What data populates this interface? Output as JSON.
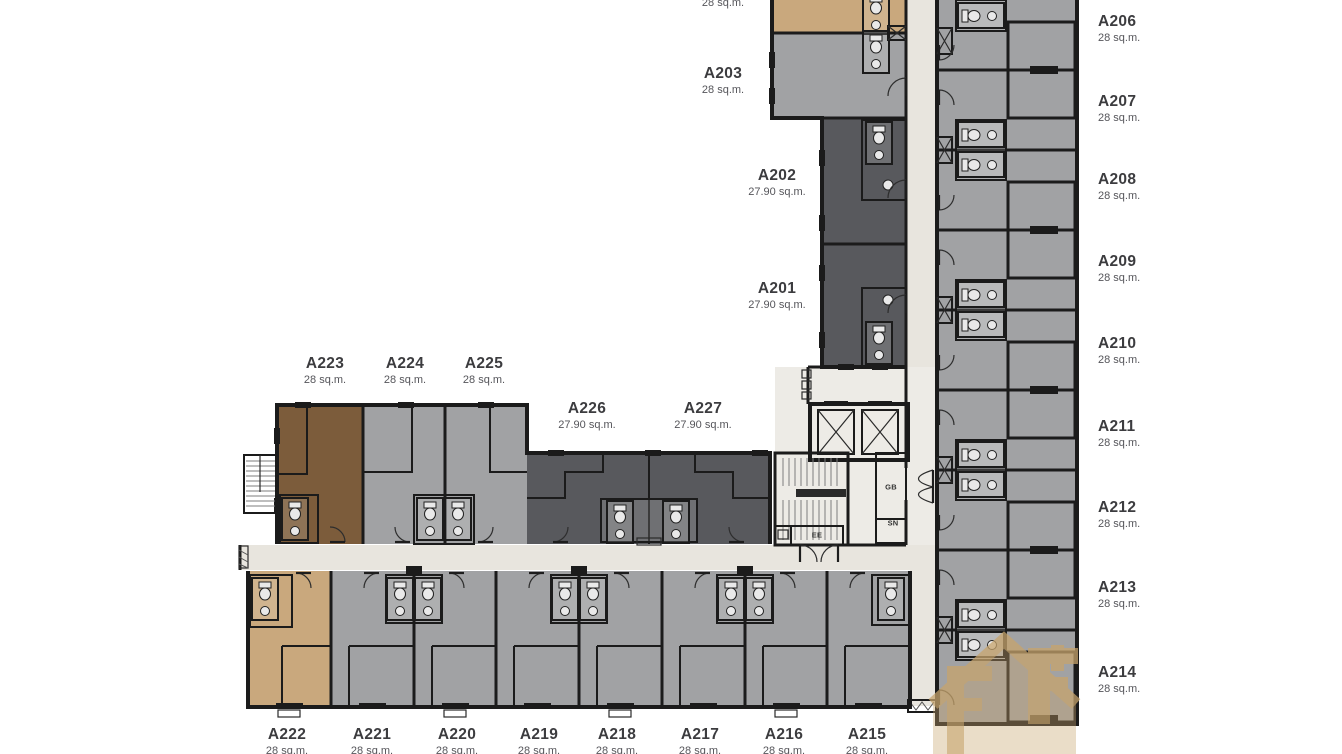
{
  "units": [
    {
      "name": "A201",
      "area": "27.90 sq.m."
    },
    {
      "name": "A202",
      "area": "27.90 sq.m."
    },
    {
      "name": "A203",
      "area": "28 sq.m."
    },
    {
      "name": "A206",
      "area": "28 sq.m."
    },
    {
      "name": "A207",
      "area": "28 sq.m."
    },
    {
      "name": "A208",
      "area": "28 sq.m."
    },
    {
      "name": "A209",
      "area": "28 sq.m."
    },
    {
      "name": "A210",
      "area": "28 sq.m."
    },
    {
      "name": "A211",
      "area": "28 sq.m."
    },
    {
      "name": "A212",
      "area": "28 sq.m."
    },
    {
      "name": "A213",
      "area": "28 sq.m."
    },
    {
      "name": "A214",
      "area": "28 sq.m."
    },
    {
      "name": "A215",
      "area": "28 sq.m."
    },
    {
      "name": "A216",
      "area": "28 sq.m."
    },
    {
      "name": "A217",
      "area": "28 sq.m."
    },
    {
      "name": "A218",
      "area": "28 sq.m."
    },
    {
      "name": "A219",
      "area": "28 sq.m."
    },
    {
      "name": "A220",
      "area": "28 sq.m."
    },
    {
      "name": "A221",
      "area": "28 sq.m."
    },
    {
      "name": "A222",
      "area": "28 sq.m."
    },
    {
      "name": "A223",
      "area": "28 sq.m."
    },
    {
      "name": "A224",
      "area": "28 sq.m."
    },
    {
      "name": "A225",
      "area": "28 sq.m."
    },
    {
      "name": "A226",
      "area": "27.90 sq.m."
    },
    {
      "name": "A227",
      "area": "27.90 sq.m."
    }
  ],
  "partial_label": {
    "area": "28 sq.m."
  },
  "core_labels": {
    "gb": "GB",
    "sn": "SN",
    "ee": "EE"
  },
  "colors": {
    "unit_gray": "#a1a2a4",
    "unit_dark": "#58595d",
    "unit_brown": "#7c5c3b",
    "unit_tan": "#c9a87d",
    "corridor": "#e8e5de",
    "corridor_light": "#edebe6",
    "wall": "#1b1b1b",
    "fixture": "#e9e9e9",
    "label_text": "#3c3c3f",
    "label_sub": "#55555a",
    "watermark": "#c7a46c"
  }
}
